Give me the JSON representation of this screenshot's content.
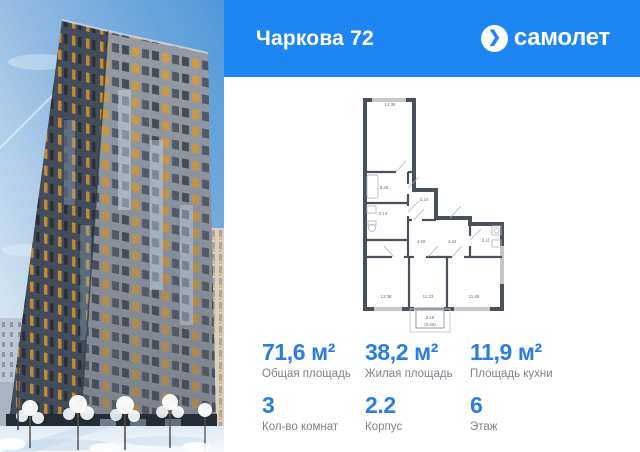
{
  "header": {
    "title": "Чаркова 72"
  },
  "brand": {
    "wordmark": "самолет",
    "chevron": "❯",
    "accent_blue": "#1e86f2",
    "stat_blue": "#2a7de2"
  },
  "photo": {
    "description": "high-rise residential tower in winter, snowy trees"
  },
  "plan": {
    "rooms": [
      {
        "id": "room-top",
        "area": "14.36"
      },
      {
        "id": "bath-1",
        "area": "3.25"
      },
      {
        "id": "bath-2",
        "area": "3.14"
      },
      {
        "id": "storage",
        "area": "3.24"
      },
      {
        "id": "hall-1",
        "area": "4.99"
      },
      {
        "id": "hall-2",
        "area": "4.44"
      },
      {
        "id": "wc",
        "area": "2.11"
      },
      {
        "id": "bedroom-1",
        "area": "12.38"
      },
      {
        "id": "bedroom-2",
        "area": "11.23"
      },
      {
        "id": "kitchen",
        "area": "11.88"
      }
    ],
    "balcony": {
      "area": "2.18",
      "coefficient": "(0.65)"
    }
  },
  "stats": {
    "items": [
      {
        "value": "71,6 м²",
        "label": "Общая площадь"
      },
      {
        "value": "38,2 м²",
        "label": "Жилая площадь"
      },
      {
        "value": "11,9 м²",
        "label": "Площадь кухни"
      },
      {
        "value": "3",
        "label": "Кол-во комнат"
      },
      {
        "value": "2.2",
        "label": "Корпус"
      },
      {
        "value": "6",
        "label": "Этаж"
      }
    ]
  }
}
